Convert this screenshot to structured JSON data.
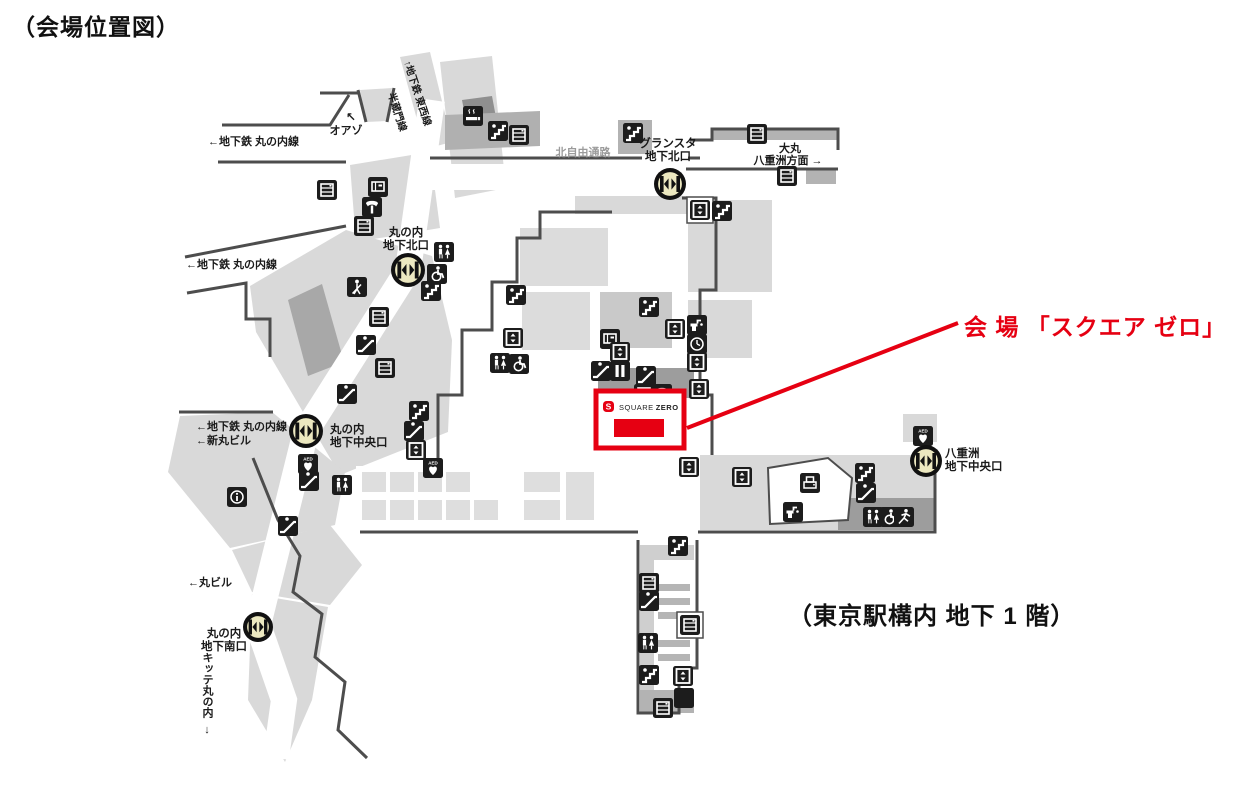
{
  "page_title": "（会場位置図）",
  "floor_note": "（東京駅構内 地下 1 階）",
  "venue_callout": {
    "label": "会 場 「スクエア ゼロ」"
  },
  "venue_box": {
    "logo_mark": "S",
    "name_regular": "SQUARE",
    "name_bold": "ZERO"
  },
  "colors": {
    "accent_red": "#e60012",
    "icon_black": "#1c1c1c",
    "wall_gray": "#4d4d4d",
    "gate_fill": "#ece8c0",
    "light_gray": "#d9d9d9",
    "medium_gray": "#b0b0b0",
    "label_black": "#1a1a1a",
    "gray_text": "#9b9b9b"
  },
  "map": {
    "gates": [
      {
        "id": "gransta-kita",
        "x": 670,
        "y": 184,
        "r": 16,
        "label_lines": [
          "グランスタ",
          "地下北口"
        ],
        "lx": 668,
        "ly": 147,
        "anchor": "middle"
      },
      {
        "id": "marunouchi-kita",
        "x": 408,
        "y": 270,
        "r": 17,
        "label_lines": [
          "丸の内",
          "地下北口"
        ],
        "lx": 406,
        "ly": 236,
        "anchor": "middle"
      },
      {
        "id": "marunouchi-chuo",
        "x": 306,
        "y": 431,
        "r": 17,
        "label_lines": [
          "丸の内",
          "地下中央口"
        ],
        "lx": 330,
        "ly": 433,
        "anchor": "start"
      },
      {
        "id": "marunouchi-minami",
        "x": 258,
        "y": 627,
        "r": 15,
        "label_lines": [
          "丸の内",
          "地下南口"
        ],
        "lx": 224,
        "ly": 637,
        "anchor": "middle"
      },
      {
        "id": "yaesu-chuo",
        "x": 926,
        "y": 461,
        "r": 16,
        "label_lines": [
          "八重洲",
          "地下中央口"
        ],
        "lx": 945,
        "ly": 457,
        "anchor": "start"
      }
    ],
    "labels": [
      {
        "id": "oazo-arrow",
        "text": "↖",
        "x": 351,
        "y": 121,
        "anchor": "middle",
        "size": 12
      },
      {
        "id": "oazo",
        "text": "オアゾ",
        "x": 346,
        "y": 134,
        "anchor": "middle",
        "size": 11
      },
      {
        "id": "metro-marunouchi-line-1",
        "text": "←地下鉄 丸の内線",
        "x": 208,
        "y": 145,
        "anchor": "start",
        "size": 11
      },
      {
        "id": "metro-tozai-line",
        "text": "↑地下鉄 東西線",
        "x": 404,
        "y": 62,
        "anchor": "start",
        "size": 10,
        "rotate": 72
      },
      {
        "id": "metro-hanzomon-line",
        "text": "半蔵門線",
        "x": 388,
        "y": 94,
        "anchor": "start",
        "size": 10,
        "rotate": 72
      },
      {
        "id": "kita-jiyu-tsuro",
        "text": "北自由通路",
        "x": 583,
        "y": 156,
        "anchor": "middle",
        "size": 11,
        "color": "gray"
      },
      {
        "id": "daimaru",
        "text": "大丸",
        "x": 790,
        "y": 152,
        "anchor": "middle",
        "size": 11
      },
      {
        "id": "yaesu-homen",
        "text": "八重洲方面 →",
        "x": 788,
        "y": 164,
        "anchor": "middle",
        "size": 11
      },
      {
        "id": "metro-marunouchi-line-2",
        "text": "←地下鉄 丸の内線",
        "x": 186,
        "y": 268,
        "anchor": "start",
        "size": 11
      },
      {
        "id": "metro-marunouchi-line-3",
        "text": "←地下鉄 丸の内線",
        "x": 196,
        "y": 430,
        "anchor": "start",
        "size": 11
      },
      {
        "id": "shin-maru-biru",
        "text": "←新丸ビル",
        "x": 196,
        "y": 444,
        "anchor": "start",
        "size": 11
      },
      {
        "id": "maru-biru",
        "text": "←丸ビル",
        "x": 188,
        "y": 586,
        "anchor": "start",
        "size": 11
      },
      {
        "id": "kitte-marunouchi",
        "text": "キッテ丸の内",
        "x": 207,
        "y": 652,
        "anchor": "start",
        "size": 11,
        "vertical": true
      },
      {
        "id": "kitte-arrow",
        "text": "↓",
        "x": 207,
        "y": 733,
        "anchor": "middle",
        "size": 11
      }
    ],
    "icons": [
      {
        "t": "smoking",
        "x": 473,
        "y": 116
      },
      {
        "t": "stairs",
        "x": 498,
        "y": 131
      },
      {
        "t": "locker",
        "x": 519,
        "y": 135
      },
      {
        "t": "stairs",
        "x": 633,
        "y": 133
      },
      {
        "t": "locker",
        "x": 757,
        "y": 134
      },
      {
        "t": "locker",
        "x": 787,
        "y": 176
      },
      {
        "t": "elevator",
        "x": 700,
        "y": 210,
        "v": "boxed"
      },
      {
        "t": "stairs",
        "x": 722,
        "y": 211
      },
      {
        "t": "ticket",
        "x": 378,
        "y": 187
      },
      {
        "t": "phone",
        "x": 372,
        "y": 207
      },
      {
        "t": "locker",
        "x": 364,
        "y": 226
      },
      {
        "t": "locker",
        "x": 327,
        "y": 190
      },
      {
        "t": "toilets",
        "x": 444,
        "y": 252
      },
      {
        "t": "wheelchair",
        "x": 437,
        "y": 274
      },
      {
        "t": "stairs",
        "x": 431,
        "y": 291
      },
      {
        "t": "guide",
        "x": 357,
        "y": 287
      },
      {
        "t": "locker",
        "x": 379,
        "y": 317
      },
      {
        "t": "escalator",
        "x": 366,
        "y": 345
      },
      {
        "t": "locker",
        "x": 385,
        "y": 368
      },
      {
        "t": "escalator",
        "x": 347,
        "y": 394
      },
      {
        "t": "stairs",
        "x": 419,
        "y": 411
      },
      {
        "t": "escalator",
        "x": 414,
        "y": 431
      },
      {
        "t": "elevator",
        "x": 416,
        "y": 450
      },
      {
        "t": "aed",
        "x": 308,
        "y": 464
      },
      {
        "t": "escalator",
        "x": 309,
        "y": 481
      },
      {
        "t": "info",
        "x": 237,
        "y": 497
      },
      {
        "t": "toilets",
        "x": 342,
        "y": 485
      },
      {
        "t": "escalator",
        "x": 288,
        "y": 526
      },
      {
        "t": "aed",
        "x": 433,
        "y": 468
      },
      {
        "t": "stairs",
        "x": 516,
        "y": 295
      },
      {
        "t": "elevator",
        "x": 513,
        "y": 338
      },
      {
        "t": "toilets",
        "x": 500,
        "y": 363
      },
      {
        "t": "wheelchair",
        "x": 519,
        "y": 364
      },
      {
        "t": "stairs",
        "x": 649,
        "y": 307
      },
      {
        "t": "elevator",
        "x": 675,
        "y": 329
      },
      {
        "t": "fountain",
        "x": 697,
        "y": 325
      },
      {
        "t": "clock",
        "x": 697,
        "y": 344
      },
      {
        "t": "elevator",
        "x": 697,
        "y": 362
      },
      {
        "t": "ticket",
        "x": 610,
        "y": 339
      },
      {
        "t": "elevator",
        "x": 620,
        "y": 352
      },
      {
        "t": "escalator",
        "x": 601,
        "y": 371
      },
      {
        "t": "walkway",
        "x": 620,
        "y": 371
      },
      {
        "t": "escalator",
        "x": 646,
        "y": 376
      },
      {
        "t": "locker",
        "x": 644,
        "y": 394
      },
      {
        "t": "phone",
        "x": 662,
        "y": 394
      },
      {
        "t": "elevator",
        "x": 699,
        "y": 389
      },
      {
        "t": "elevator",
        "x": 742,
        "y": 477
      },
      {
        "t": "copy",
        "x": 810,
        "y": 483
      },
      {
        "t": "fountain",
        "x": 793,
        "y": 512
      },
      {
        "t": "stairs",
        "x": 865,
        "y": 473
      },
      {
        "t": "escalator",
        "x": 866,
        "y": 493
      },
      {
        "t": "toilets",
        "x": 873,
        "y": 517
      },
      {
        "t": "wheelchair",
        "x": 890,
        "y": 517
      },
      {
        "t": "run",
        "x": 904,
        "y": 517
      },
      {
        "t": "aed",
        "x": 923,
        "y": 436
      },
      {
        "t": "elevator",
        "x": 689,
        "y": 467
      },
      {
        "t": "stairs",
        "x": 678,
        "y": 546
      },
      {
        "t": "locker",
        "x": 649,
        "y": 583
      },
      {
        "t": "escalator",
        "x": 649,
        "y": 601
      },
      {
        "t": "locker",
        "x": 690,
        "y": 625,
        "v": "boxed"
      },
      {
        "t": "toilets",
        "x": 648,
        "y": 643
      },
      {
        "t": "stairs",
        "x": 649,
        "y": 675
      },
      {
        "t": "elevator",
        "x": 683,
        "y": 676
      },
      {
        "t": "bag",
        "x": 684,
        "y": 698
      },
      {
        "t": "locker",
        "x": 663,
        "y": 708
      }
    ]
  }
}
